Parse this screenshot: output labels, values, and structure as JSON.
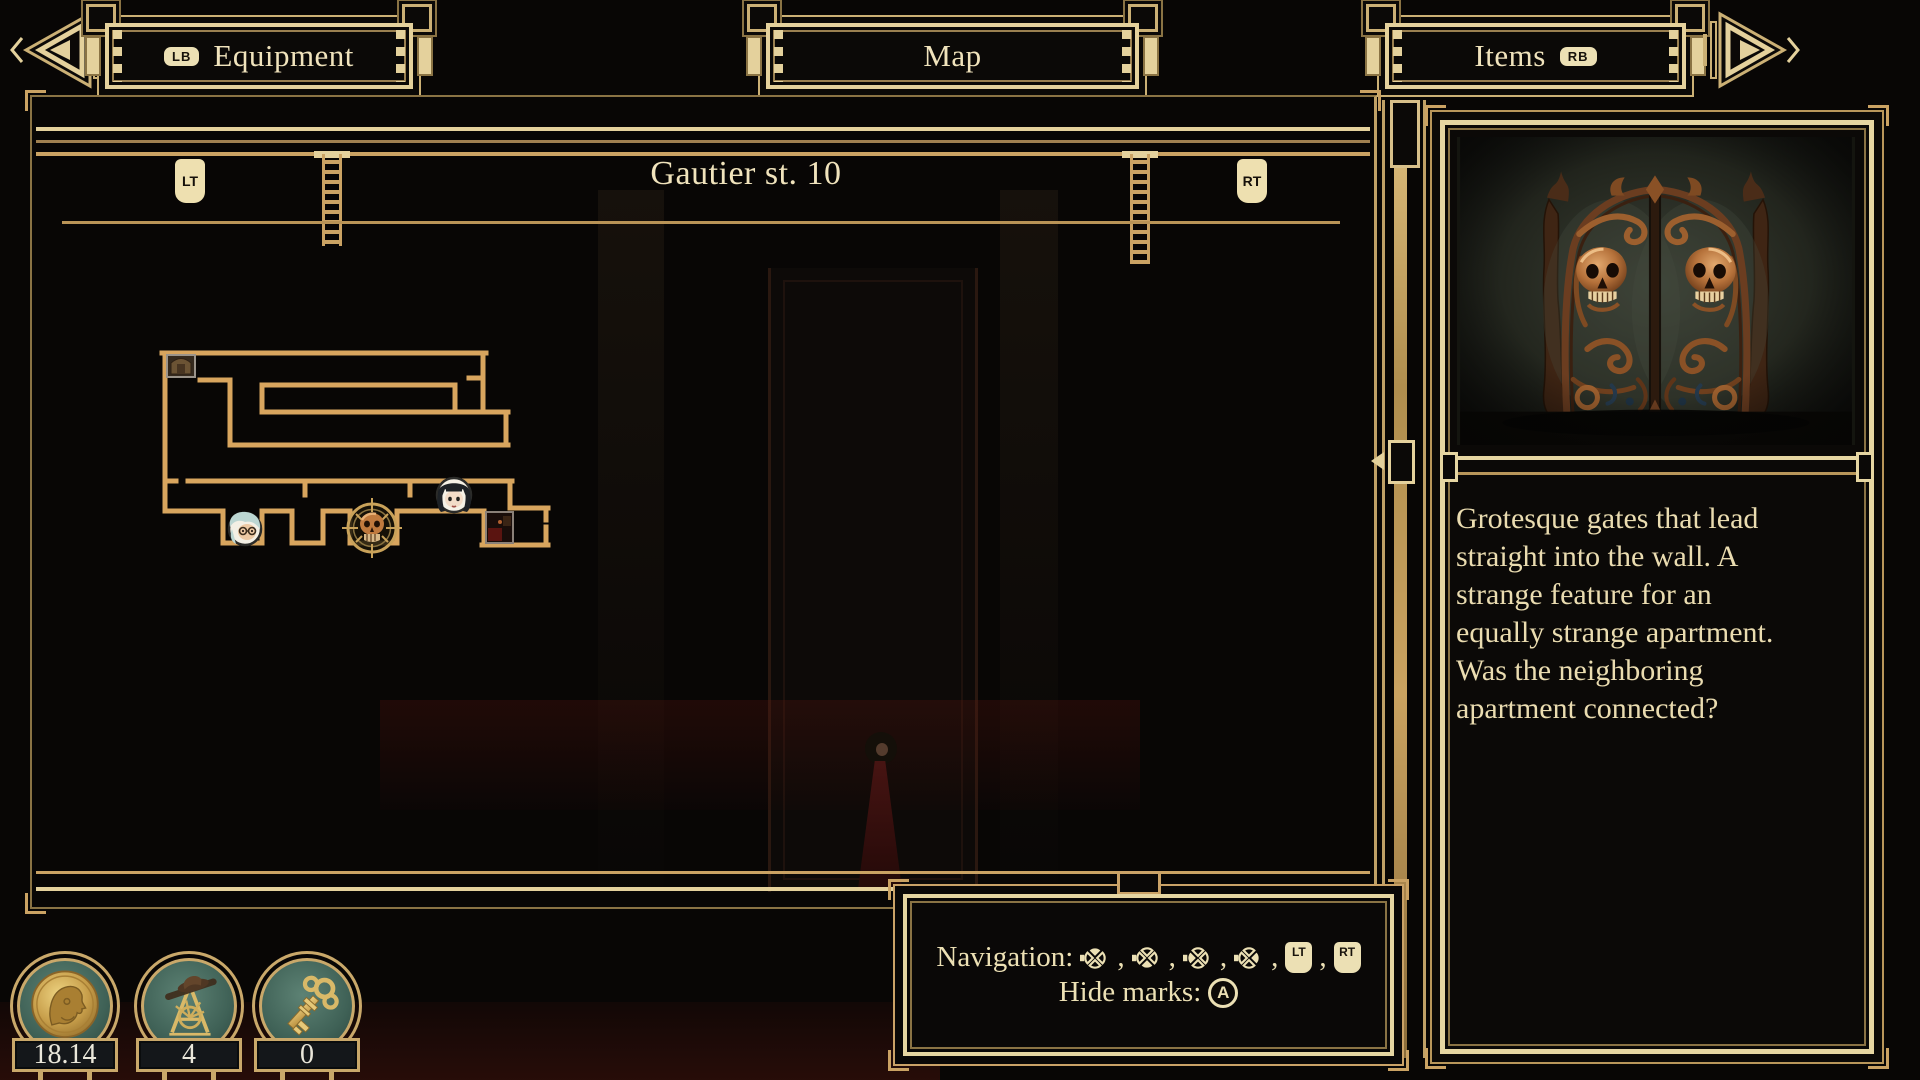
{
  "top_bar": {
    "prev_tab": {
      "shortcut": "LB",
      "label": "Equipment"
    },
    "current_tab": {
      "label": "Map"
    },
    "next_tab": {
      "label": "Items",
      "shortcut": "RB"
    }
  },
  "map_panel": {
    "title": "Gautier st. 10",
    "left_trigger_label": "LT",
    "right_trigger_label": "RT",
    "marks": [
      {
        "name": "furniture-thumbnail-mark"
      },
      {
        "name": "elderly-woman-portrait-mark"
      },
      {
        "name": "skull-selected-mark"
      },
      {
        "name": "player-portrait-mark"
      },
      {
        "name": "room-thumbnail-mark"
      }
    ]
  },
  "item_panel": {
    "image": "grotesque-gates-illustration",
    "description_lines": [
      "Grotesque gates that lead",
      "straight into the wall. A",
      "strange feature for an",
      "equally strange apartment.",
      "Was the neighboring",
      "apartment connected?"
    ]
  },
  "hint_panel": {
    "navigation_label": "Navigation:",
    "navigation_buttons": [
      "dpad-up",
      "dpad-down",
      "dpad-left",
      "dpad-right",
      "LT",
      "RT"
    ],
    "separator": ",",
    "hide_marks_label": "Hide marks:",
    "hide_marks_button": "A"
  },
  "resources": [
    {
      "name": "money",
      "icon": "coin-icon",
      "value": "18.14"
    },
    {
      "name": "drafting-tools",
      "icon": "easel-icon",
      "value": "4"
    },
    {
      "name": "keys",
      "icon": "key-icon",
      "value": "0"
    }
  ],
  "colors": {
    "gold": "#d8a55e",
    "frame_gold": "#caa263",
    "cream": "#e4d19c",
    "text_cream": "#ecdfb2",
    "background": "#080605",
    "badge_teal": "#4e7266",
    "copper": "#b5713a"
  }
}
